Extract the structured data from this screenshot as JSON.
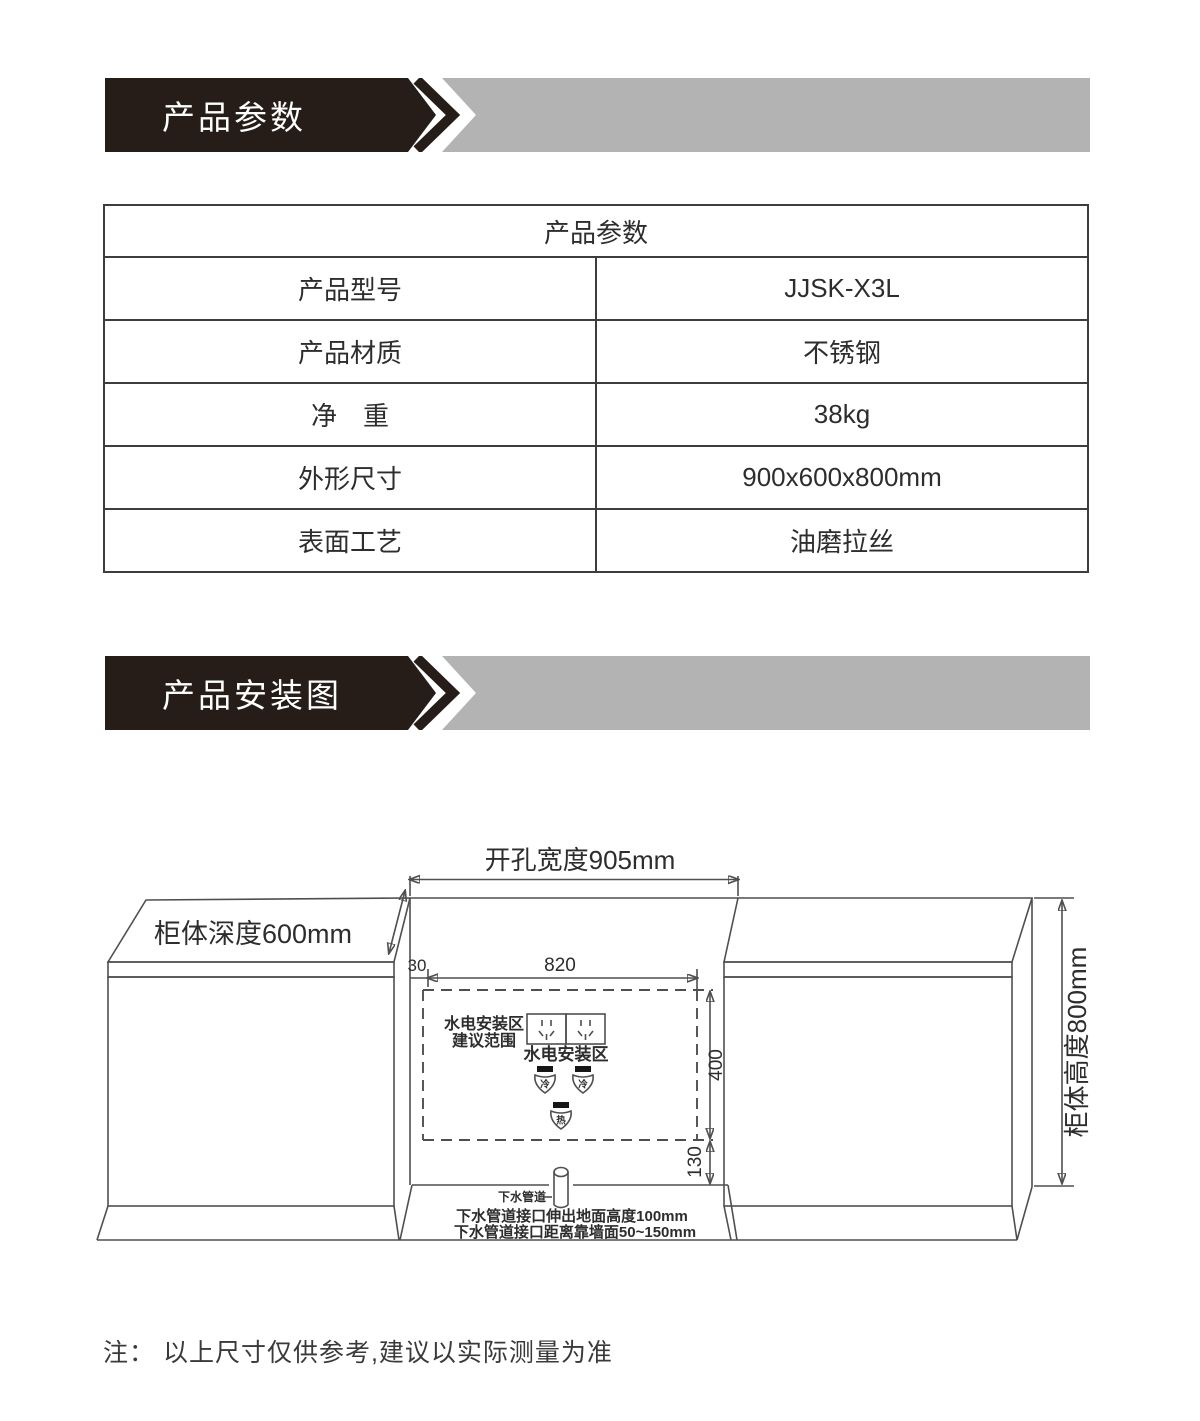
{
  "colors": {
    "banner_black": "#261c18",
    "banner_gray": "#b3b3b3",
    "table_border": "#3d3d3d",
    "diagram_line": "#4f4f4f"
  },
  "banners": {
    "params": {
      "label": "产品参数"
    },
    "install": {
      "label": "产品安装图"
    }
  },
  "spec_table": {
    "title": "产品参数",
    "rows": [
      {
        "label": "产品型号",
        "value": "JJSK-X3L"
      },
      {
        "label": "产品材质",
        "value": "不锈钢"
      },
      {
        "label": "净　重",
        "value": "38kg"
      },
      {
        "label": "外形尺寸",
        "value": "900x600x800mm"
      },
      {
        "label": "表面工艺",
        "value": "油磨拉丝"
      }
    ]
  },
  "diagram": {
    "dim_opening_width": "开孔宽度905mm",
    "dim_cabinet_depth": "柜体深度600mm",
    "dim_cabinet_height": "柜体高度800mm",
    "dim_30": "30",
    "dim_820": "820",
    "dim_400": "400",
    "dim_130": "130",
    "zone_note_line1": "水电安装区",
    "zone_note_line2": "建议范围",
    "zone_label": "水电安装区",
    "valve_cold": "冷",
    "valve_hot": "热",
    "pipe_label": "下水管道",
    "pipe_note1": "下水管道接口伸出地面高度100mm",
    "pipe_note2": "下水管道接口距离靠墙面50~150mm"
  },
  "footnote": "注： 以上尺寸仅供参考,建议以实际测量为准"
}
